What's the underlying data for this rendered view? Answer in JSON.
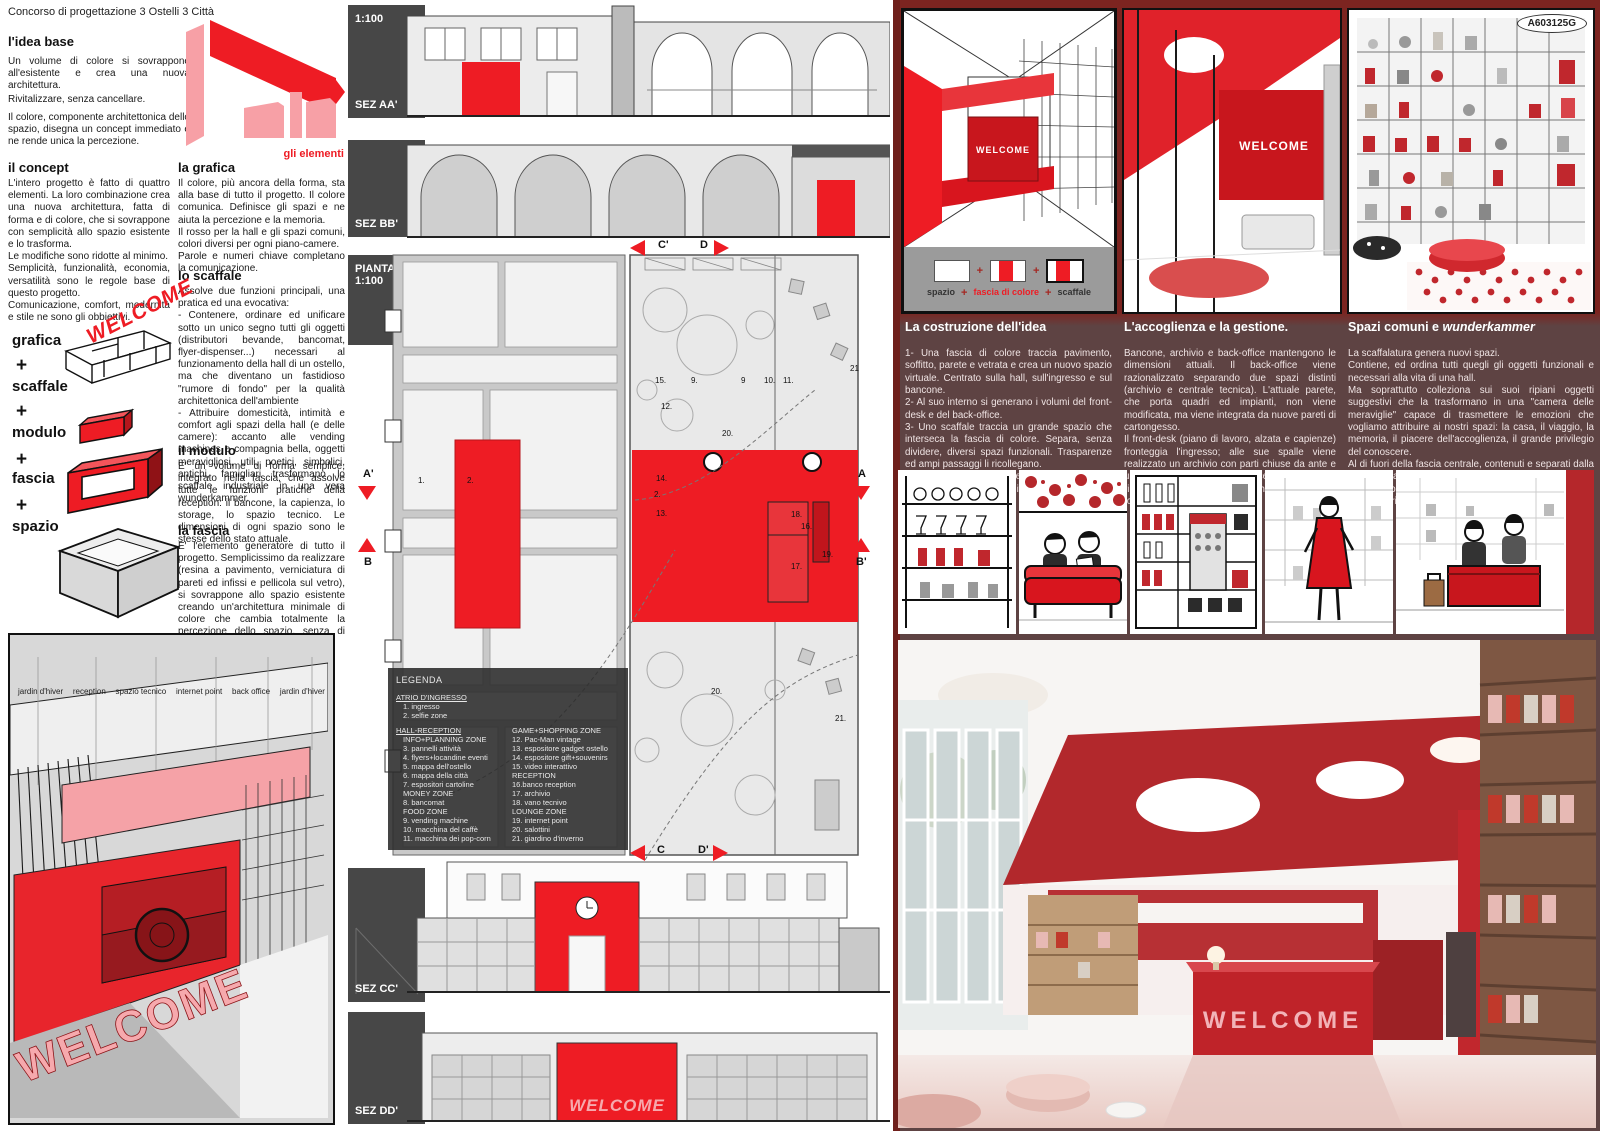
{
  "welcome": "WELCOME",
  "header": {
    "title": "Concorso di progettazione 3 Ostelli 3 Città",
    "code": "A603125G"
  },
  "colors": {
    "red": "#ee1c24",
    "pink": "#f6a3a8",
    "dark_panel": "#5e4343",
    "maroon": "#7c2420"
  },
  "left": {
    "idea": {
      "heading": "l'idea base",
      "p1": "Un volume di colore si sovrappone all'esistente e crea una nuova architettura.",
      "p2": "Rivitalizzare, senza cancellare.",
      "p3": "Il colore, componente architettonica dello spazio, disegna un concept immediato e ne rende unica la percezione."
    },
    "gli_elementi": "gli elementi",
    "concept": {
      "heading": "il concept",
      "body": "L'intero progetto è fatto di quattro elementi. La loro combinazione crea una nuova architettura, fatta di forma e di colore, che si sovrappone con semplicità allo spazio esistente e lo trasforma.\nLe modifiche sono ridotte al minimo.\nSemplicità, funzionalità, economia, versatilità sono le regole base di questo progetto.\nComunicazione, comfort, modernità e stile ne sono gli obbiettivi."
    },
    "grafica": {
      "heading": "la grafica",
      "body": "Il colore, più ancora della forma, sta alla base di tutto il progetto. Il colore comunica. Definisce gli spazi e ne aiuta la percezione e la memoria.\nIl rosso per la hall e gli spazi comuni, colori diversi per ogni piano-camere.\nParole e numeri chiave completano la comunicazione."
    },
    "scaffale": {
      "heading": "lo scaffale",
      "body": "Assolve due funzioni principali, una pratica ed una evocativa:\n- Contenere, ordinare ed unificare sotto un unico segno tutti gli oggetti (distributori bevande, bancomat, flyer-dispenser...) necessari al funzionamento della hall di un ostello, ma che diventano un fastidioso \"rumore di fondo\" per la qualità architettonica dell'ambiente\n- Attribuire domesticità, intimità e comfort agli spazi della hall (e delle camere): accanto alle vending machines e compagnia bella, oggetti meravigliosi, utili, poetici, simbolici, antichi, famigliari trasformano lo scaffale industriale in una vera wunderkammer."
    },
    "modulo": {
      "heading": "il modulo",
      "body": "E' un volume di forma semplice, integrato nella fascia, che assolve tutte le funzioni pratiche della reception: il bancone, la capienza, lo storage, lo spazio tecnico. Le dimensioni di ogni spazio sono le stesse dello stato attuale."
    },
    "fascia": {
      "heading": "la fascia",
      "body": "E' l'elemento generatore di tutto il progetto. Semplicissimo da realizzare (resina a pavimento, verniciatura di pareti ed infissi e pellicola sul vetro), si sovrappone allo spazio esistente creando un'architettura minimale di colore che cambia totalmente la percezione dello spazio, senza di fatto modificarlo."
    },
    "elements": [
      "grafica",
      "scaffale",
      "modulo",
      "fascia",
      "spazio"
    ],
    "plus": "+",
    "render_labels": [
      "jardin d'hiver",
      "reception",
      "spazio tecnico",
      "internet point",
      "back office",
      "jardin d'hiver"
    ]
  },
  "middle": {
    "scale": "1:100",
    "sections": [
      "SEZ AA'",
      "SEZ BB'",
      "SEZ CC'",
      "SEZ DD'"
    ],
    "plan_label": "PIANTA 1:100",
    "markers": {
      "c1": "C'",
      "d": "D",
      "a1": "A'",
      "b": "B",
      "a": "A",
      "b1": "B'",
      "c": "C",
      "d1": "D'"
    },
    "legend": {
      "title": "LEGENDA",
      "atrio_header": "ATRIO D'INGRESSO",
      "atrio_items": [
        "1. ingresso",
        "2. selfie zone"
      ],
      "col1_header": "HALL-RECEPTION",
      "col1_items": [
        "INFO+PLANNING ZONE",
        "3. pannelli attività",
        "4. flyers+locandine eventi",
        "5. mappa dell'ostello",
        "6. mappa della città",
        "7. espositori cartoline",
        "MONEY ZONE",
        "8. bancomat",
        "FOOD ZONE",
        "9. vending machine",
        "10. macchina del caffè",
        "11. macchina dei pop-corn"
      ],
      "col2_header": "GAME+SHOPPING ZONE",
      "col2_items": [
        "12. Pac-Man vintage",
        "13. espositore gadget ostello",
        "14. espositore gift+souvenirs",
        "15. video interattivo",
        "RECEPTION",
        "16.banco reception",
        "17. archivio",
        "18. vano tecnivo",
        "LOUNGE ZONE",
        "19. internet point",
        "20. salottini",
        "21. giardino d'inverno"
      ]
    },
    "plan_numbers": [
      {
        "n": "1.",
        "x": 73,
        "y": 226
      },
      {
        "n": "2.",
        "x": 122,
        "y": 226
      },
      {
        "n": "15.",
        "x": 310,
        "y": 126
      },
      {
        "n": "9.",
        "x": 346,
        "y": 126
      },
      {
        "n": "9",
        "x": 396,
        "y": 126
      },
      {
        "n": "10.",
        "x": 419,
        "y": 126
      },
      {
        "n": "11.",
        "x": 438,
        "y": 126
      },
      {
        "n": "21",
        "x": 505,
        "y": 114
      },
      {
        "n": "12.",
        "x": 316,
        "y": 152
      },
      {
        "n": "20.",
        "x": 377,
        "y": 179
      },
      {
        "n": "14.",
        "x": 311,
        "y": 224
      },
      {
        "n": "2.",
        "x": 309,
        "y": 240
      },
      {
        "n": "13.",
        "x": 311,
        "y": 259
      },
      {
        "n": "18.",
        "x": 446,
        "y": 260
      },
      {
        "n": "16.",
        "x": 456,
        "y": 272
      },
      {
        "n": "17.",
        "x": 446,
        "y": 312
      },
      {
        "n": "19.",
        "x": 477,
        "y": 300
      },
      {
        "n": "20.",
        "x": 366,
        "y": 437
      },
      {
        "n": "21.",
        "x": 490,
        "y": 464
      }
    ]
  },
  "right": {
    "diagram": {
      "labels": [
        "spazio",
        "fascia di colore",
        "scaffale"
      ]
    },
    "columns": [
      {
        "heading": "La costruzione dell'idea",
        "body": "1- Una fascia di colore traccia pavimento, soffitto, parete e vetrata e crea un nuovo spazio virtuale. Centrato sulla hall, sull'ingresso e sul bancone.\n2- Al suo interno si generano i volumi del front-desk e del back-office.\n3- Uno scaffale traccia un grande spazio che interseca la fascia di colore. Separa, senza dividere, diversi spazi funzionali. Trasparenze ed ampi passaggi li ricollegano.\nNessun elemento esistente, impianto, luce parete, infisso, viene modificato né sostituito"
      },
      {
        "heading": "L'accoglienza e la gestione.",
        "body": "Bancone, archivio e back-office mantengono le dimensioni attuali. Il back-office viene razionalizzato separando due spazi distinti (archivio e centrale tecnica). L'attuale parete, che porta quadri ed impianti, non viene modificata, ma viene integrata da nuove pareti di cartongesso.\nIl front-desk (piano di lavoro, alzata e capienze) fronteggia l'ingresso; alle sue spalle viene realizzato un archivio con parti chiuse da ante e una parte a giorno, tagliata a cerchio, linea che riprende le luci del soffitto e che ritornerà nella forma dei pouffs."
      },
      {
        "heading": "Spazi comuni e ",
        "heading_italic": "wunderkammer",
        "body": "La scaffalatura genera nuovi spazi.\nContiene, ed ordina tutti quegli gli oggetti funzionali e necessari alla vita di una hall.\nMa soprattutto colleziona sui suoi ripiani oggetti suggestivi che la trasformano in una \"camera delle meraviglie\" capace di trasmettere le emozioni che vogliamo attribuire ai nostri spazi: la casa, il viaggio, la memoria, il piacere dell'accoglienza, il grande privilegio del conoscere.\nAl di fuori della fascia centrale, contenuti e separati dalla scaffalatura, si trovano gli spazi comuni, che vengono arredati con grandi pouffs e tavolini d'appoggio. Avvolti dalla libreria diventano piacevoli luoghi di incontro e di relax."
      }
    ]
  }
}
